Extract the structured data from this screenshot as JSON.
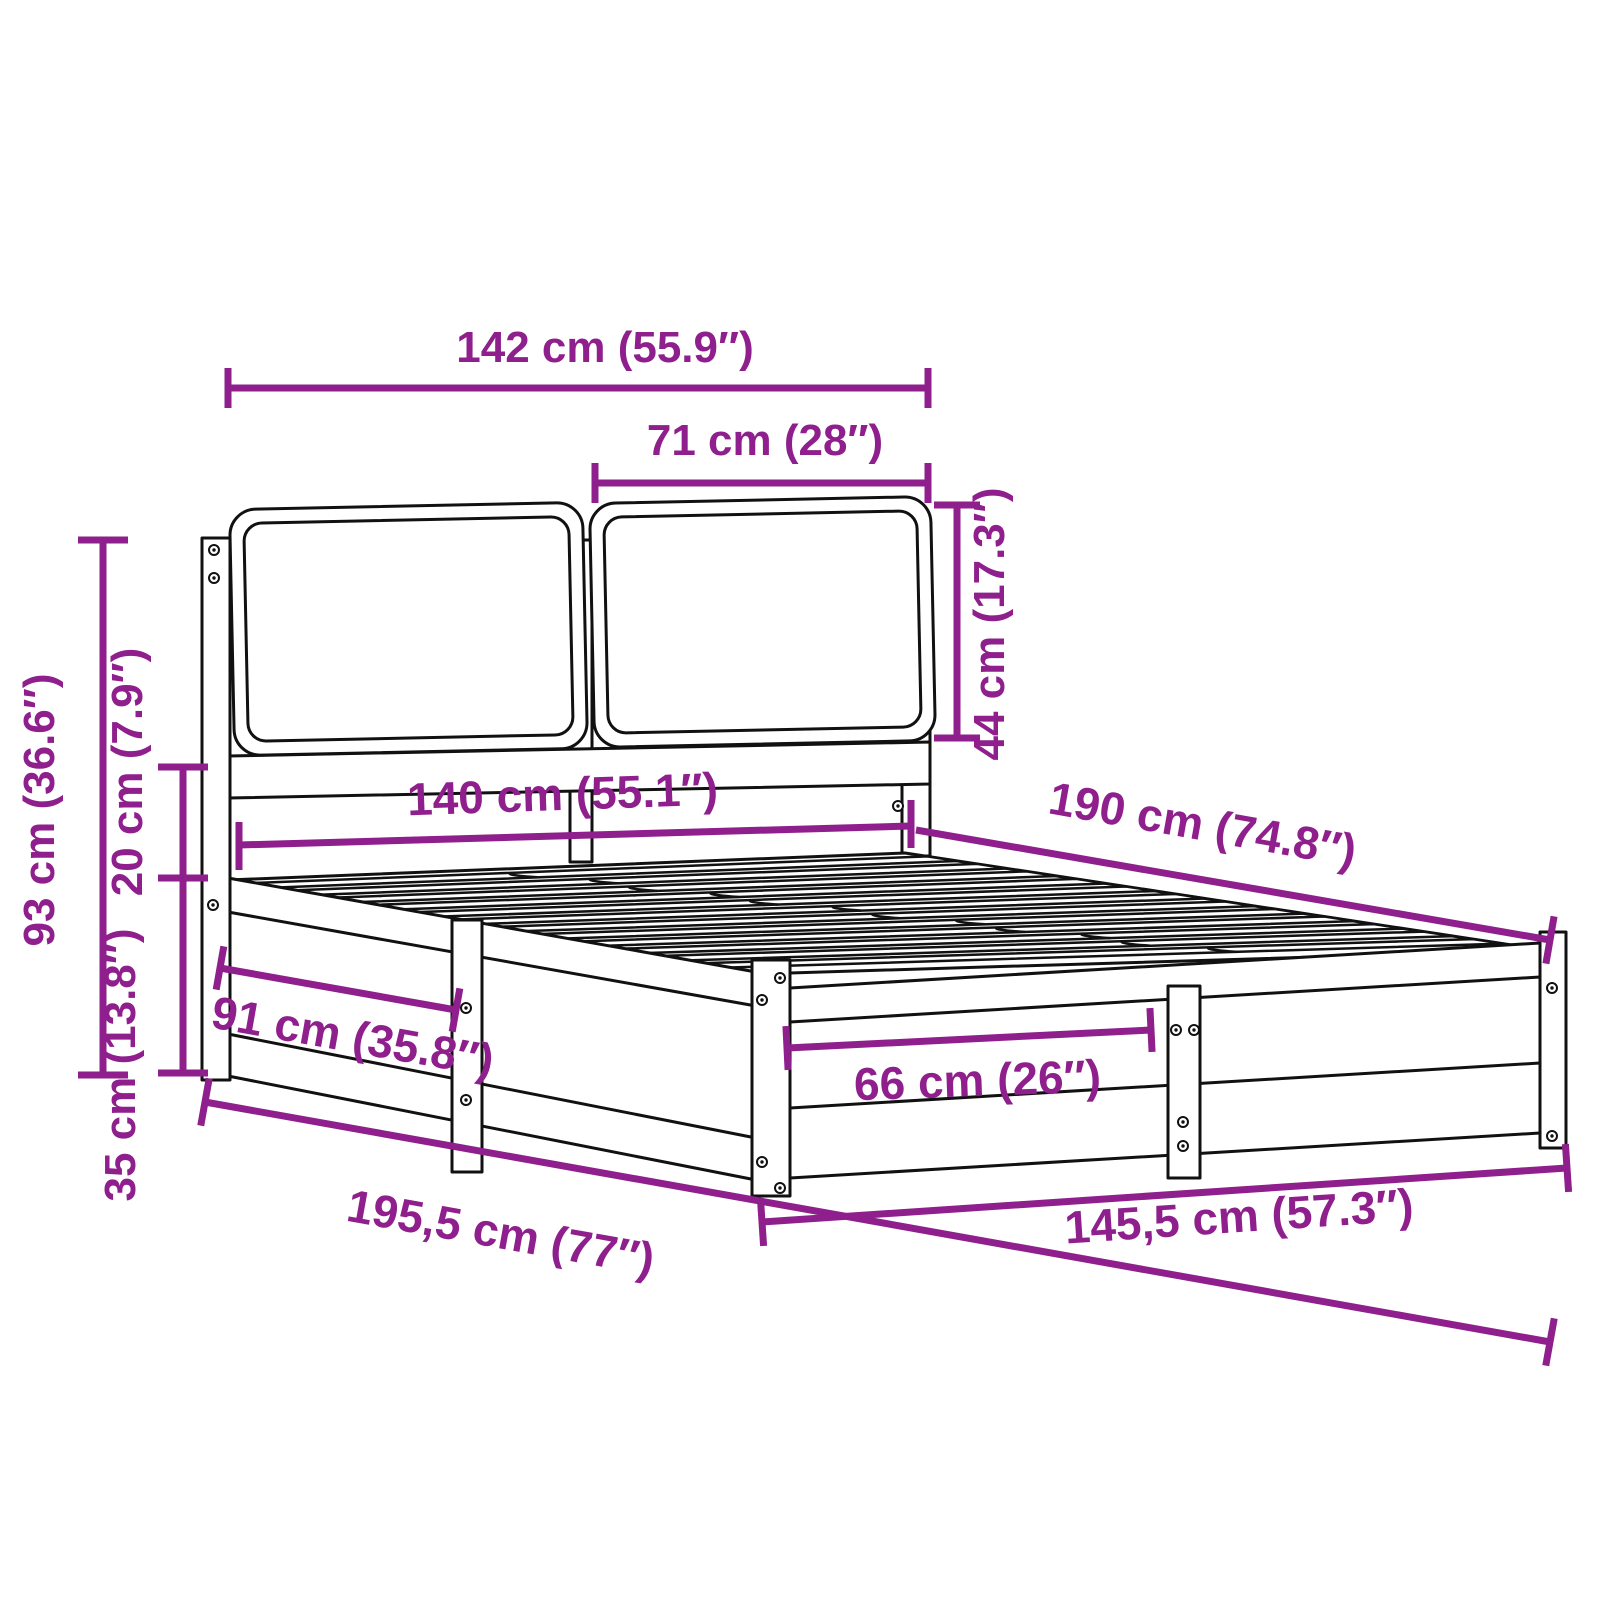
{
  "diagram": {
    "kind": "product dimension diagram",
    "subject": "bed frame with slatted base and cushion headboard",
    "accent_color": "#8E1F8C",
    "outline_color": "#111111",
    "background_color": "#ffffff",
    "dimensions": {
      "headboard_total_width": "142 cm (55.9″)",
      "cushion_width": "71 cm (28″)",
      "cushion_height": "44 cm (17.3″)",
      "headboard_height": "93 cm (36.6″)",
      "rail_gap_height": "20 cm (7.9″)",
      "frame_height": "35 cm (13.8″)",
      "inner_width": "140 cm (55.1″)",
      "inner_length": "190 cm (74.8″)",
      "side_panel_section": "91 cm (35.8″)",
      "foot_panel_section": "66 cm (26″)",
      "total_length": "195,5 cm (77″)",
      "total_width": "145,5 cm (57.3″)"
    }
  }
}
